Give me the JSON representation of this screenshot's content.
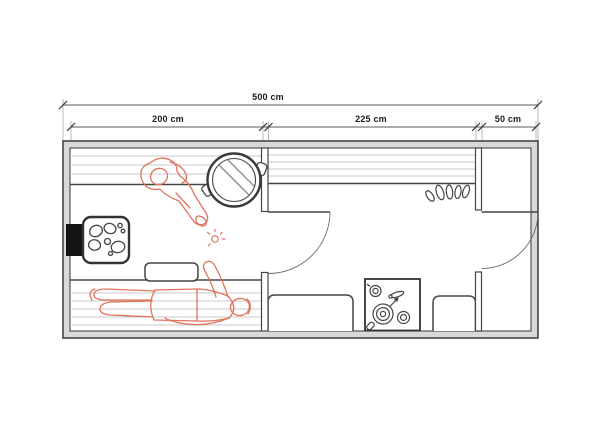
{
  "drawing": {
    "type": "floor-plan",
    "unit": "cm",
    "dimensions": {
      "total": {
        "label": "500 cm",
        "value": 500
      },
      "sections": [
        {
          "label": "200 cm",
          "value": 200
        },
        {
          "label": "225 cm",
          "value": 225
        },
        {
          "label": "50 cm",
          "value": 50
        }
      ]
    },
    "objects": [
      "chimney-block",
      "sauna-heater-with-stones",
      "upper-bench",
      "lower-bench",
      "headrest",
      "water-tub",
      "sitting-person-figure",
      "lying-person-figure",
      "steam-sparkle",
      "sauna-door",
      "wall-shelf",
      "coat-hooks",
      "counter-left",
      "gas-stove",
      "counter-right",
      "entrance-door"
    ],
    "colors": {
      "outline": "#454545",
      "wall_fill": "#d9d9d9",
      "slats": "#c9c9c9",
      "figure": "#e0735e",
      "heater_block": "#141414",
      "background": "#ffffff"
    }
  }
}
